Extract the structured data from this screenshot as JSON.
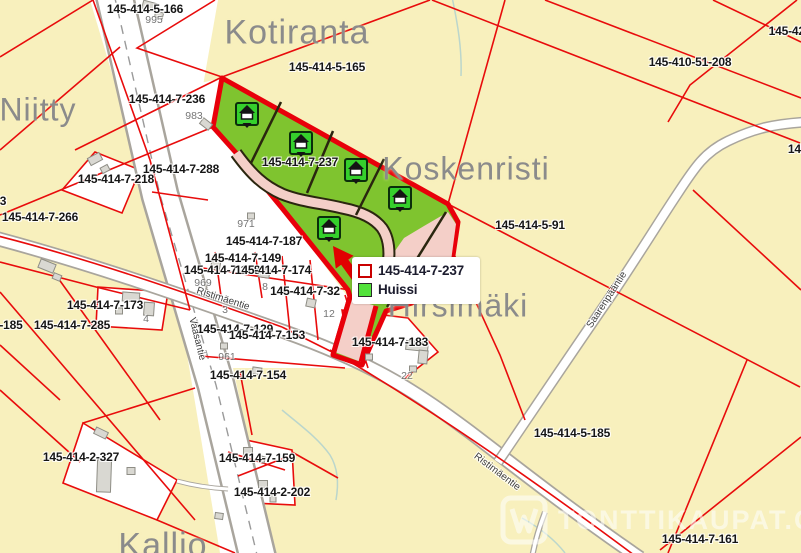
{
  "map": {
    "colors": {
      "background": "#f8f0bd",
      "parcel_line": "#e80c0c",
      "highlight_outline": "#e8000a",
      "plot_green": "#7fc42f",
      "marker_green": "#35d02c",
      "road_pink": "#f4cfc8",
      "road_fill": "#ffffff",
      "road_casing": "#a9a59d",
      "building_fill": "#d9d8d2",
      "place_text": "#8b8b8b",
      "water": "#abd0d0"
    },
    "place_labels": [
      {
        "text": "Kotiranta",
        "x": 297,
        "y": 33,
        "size": 34
      },
      {
        "text": "Niitty",
        "x": 38,
        "y": 110,
        "size": 32
      },
      {
        "text": "Koskenristi",
        "x": 466,
        "y": 169,
        "size": 32
      },
      {
        "text": "Hirsimäki",
        "x": 458,
        "y": 306,
        "size": 32
      },
      {
        "text": "Kallio",
        "x": 163,
        "y": 546,
        "size": 34
      }
    ],
    "parcel_labels": [
      {
        "text": "145-414-5-166",
        "x": 145,
        "y": 9
      },
      {
        "text": "145-414-5-165",
        "x": 327,
        "y": 67
      },
      {
        "text": "145-410-51-208",
        "x": 690,
        "y": 62
      },
      {
        "text": "145-421",
        "x": 790,
        "y": 31
      },
      {
        "text": "145-41",
        "x": 806,
        "y": 149
      },
      {
        "text": "145-414-7-236",
        "x": 167,
        "y": 99
      },
      {
        "text": "145-414-7-288",
        "x": 181,
        "y": 169
      },
      {
        "text": "145-414-7-218",
        "x": 116,
        "y": 179
      },
      {
        "text": "145-414-7-266",
        "x": 40,
        "y": 217
      },
      {
        "text": "3",
        "x": 3,
        "y": 201
      },
      {
        "text": "145-414-7-173",
        "x": 105,
        "y": 305
      },
      {
        "text": "-185",
        "x": 11,
        "y": 325
      },
      {
        "text": "145-414-7-285",
        "x": 72,
        "y": 325
      },
      {
        "text": "145-414-5-91",
        "x": 530,
        "y": 225
      },
      {
        "text": "145-414-7-237",
        "x": 300,
        "y": 162
      },
      {
        "text": "145-414-7-187",
        "x": 264,
        "y": 241
      },
      {
        "text": "145-414-7-149",
        "x": 243,
        "y": 258
      },
      {
        "text": "145-414-7-148",
        "x": 222,
        "y": 270
      },
      {
        "text": "145-414-7-174",
        "x": 273,
        "y": 270
      },
      {
        "text": "145-414-7-32",
        "x": 305,
        "y": 291
      },
      {
        "text": "145-414-7-129",
        "x": 235,
        "y": 329
      },
      {
        "text": "145-414-7-153",
        "x": 267,
        "y": 335
      },
      {
        "text": "145-414-7-183",
        "x": 390,
        "y": 342
      },
      {
        "text": "145-414-7-154",
        "x": 248,
        "y": 375
      },
      {
        "text": "145-414-5-185",
        "x": 572,
        "y": 433
      },
      {
        "text": "145-414-2-327",
        "x": 81,
        "y": 457
      },
      {
        "text": "145-414-7-159",
        "x": 257,
        "y": 458
      },
      {
        "text": "145-414-2-202",
        "x": 272,
        "y": 492
      },
      {
        "text": "145-414-7-161",
        "x": 700,
        "y": 539
      }
    ],
    "address_numbers": [
      {
        "text": "995",
        "x": 154,
        "y": 20
      },
      {
        "text": "983",
        "x": 194,
        "y": 116
      },
      {
        "text": "971",
        "x": 246,
        "y": 224
      },
      {
        "text": "969",
        "x": 203,
        "y": 283
      },
      {
        "text": "8",
        "x": 265,
        "y": 287
      },
      {
        "text": "4",
        "x": 146,
        "y": 319
      },
      {
        "text": "3",
        "x": 225,
        "y": 310
      },
      {
        "text": "12",
        "x": 329,
        "y": 314
      },
      {
        "text": "961",
        "x": 227,
        "y": 357
      },
      {
        "text": "22",
        "x": 407,
        "y": 376
      }
    ],
    "street_labels": [
      {
        "text": "Ristimäentie",
        "x": 223,
        "y": 299,
        "rot": 18
      },
      {
        "text": "Ristimäentie",
        "x": 497,
        "y": 472,
        "rot": 37
      },
      {
        "text": "Vaasantie",
        "x": 197,
        "y": 339,
        "rot": 76
      },
      {
        "text": "Saarenpääntie",
        "x": 607,
        "y": 300,
        "rot": -57
      }
    ],
    "markers": {
      "icon": "house-plot-icon",
      "positions": [
        {
          "x": 247,
          "y": 114
        },
        {
          "x": 301,
          "y": 143
        },
        {
          "x": 356,
          "y": 170
        },
        {
          "x": 400,
          "y": 198
        },
        {
          "x": 329,
          "y": 228
        }
      ]
    }
  },
  "legend": {
    "items": [
      {
        "label": "145-414-7-237",
        "swatch": "red-outline",
        "color": "#c90000"
      },
      {
        "label": "Huissi",
        "swatch": "green-fill",
        "color": "#52e23a"
      }
    ]
  },
  "watermark": {
    "text": "TONTTIKAUPAT.COM"
  }
}
